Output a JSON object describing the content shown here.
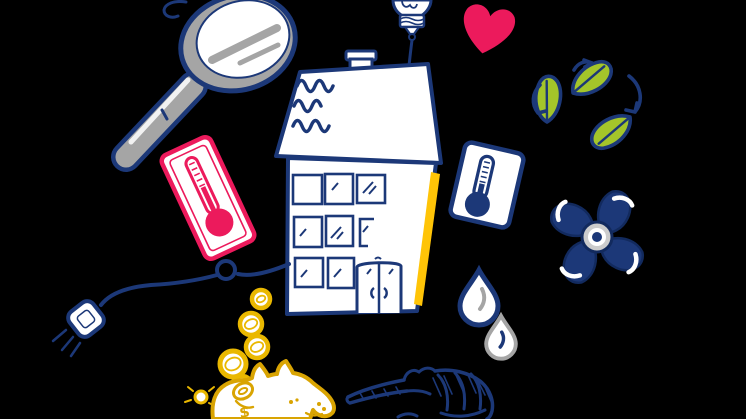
{
  "app": {
    "background": "#000000",
    "title": "Energy-saving home illustration"
  },
  "colors": {
    "navy": "#1c3878",
    "navy-dark": "#122a5e",
    "gray": "#a5a5a5",
    "gray-light": "#cccccc",
    "pink": "#ec1a5c",
    "green": "#a4c52a",
    "gold": "#d9a402",
    "coin": "#eab800",
    "yellow": "#ffc407",
    "bg": "#000000"
  },
  "illustration": {
    "piggy_bank_symbol": "$",
    "items": [
      {
        "name": "magnifying-glass"
      },
      {
        "name": "light-bulb"
      },
      {
        "name": "house-with-windows"
      },
      {
        "name": "heart"
      },
      {
        "name": "recycling-leaves"
      },
      {
        "name": "thermometer-card-hot"
      },
      {
        "name": "thermometer-card-cold"
      },
      {
        "name": "fan-propeller"
      },
      {
        "name": "water-drops"
      },
      {
        "name": "power-plug-cord"
      },
      {
        "name": "falling-coins"
      },
      {
        "name": "piggy-bank"
      },
      {
        "name": "pointing-hand"
      }
    ]
  }
}
